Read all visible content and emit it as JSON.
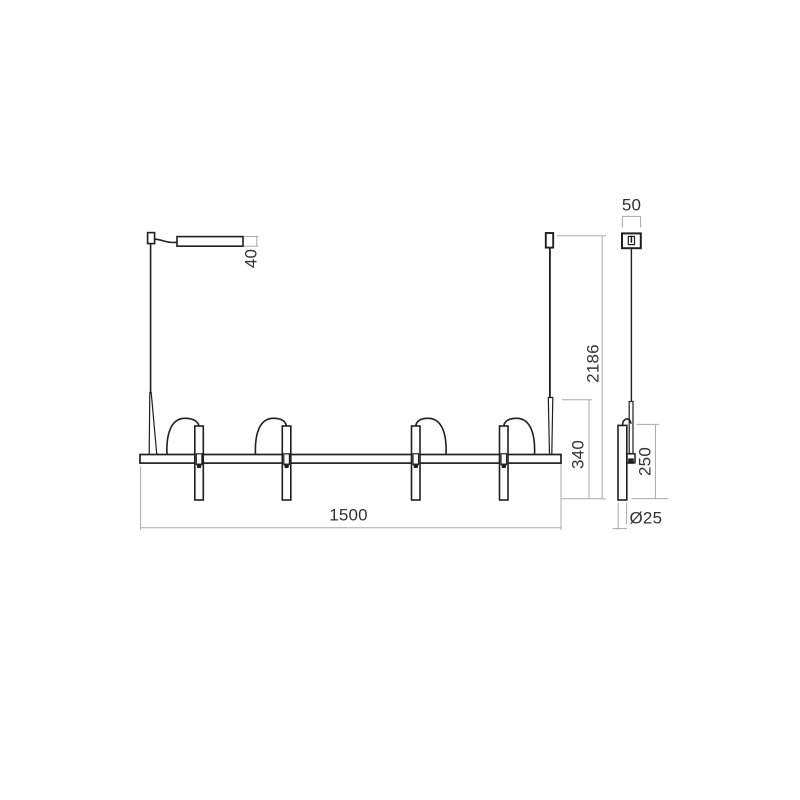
{
  "drawing": {
    "type": "technical-dimension-drawing",
    "subject": "linear-pendant-light-fixture",
    "front_view": {
      "dims": {
        "driver_height": "40",
        "bar_length": "1500",
        "fixture_drop": "340",
        "total_height": "2186"
      }
    },
    "side_view": {
      "dims": {
        "canopy_width": "50",
        "tube_length": "250",
        "tube_diameter": "Ø25"
      }
    },
    "colors": {
      "object_line": "#1f1f1f",
      "dimension_line": "#a8a8a8",
      "dimension_text": "#333333",
      "background": "#ffffff"
    }
  }
}
